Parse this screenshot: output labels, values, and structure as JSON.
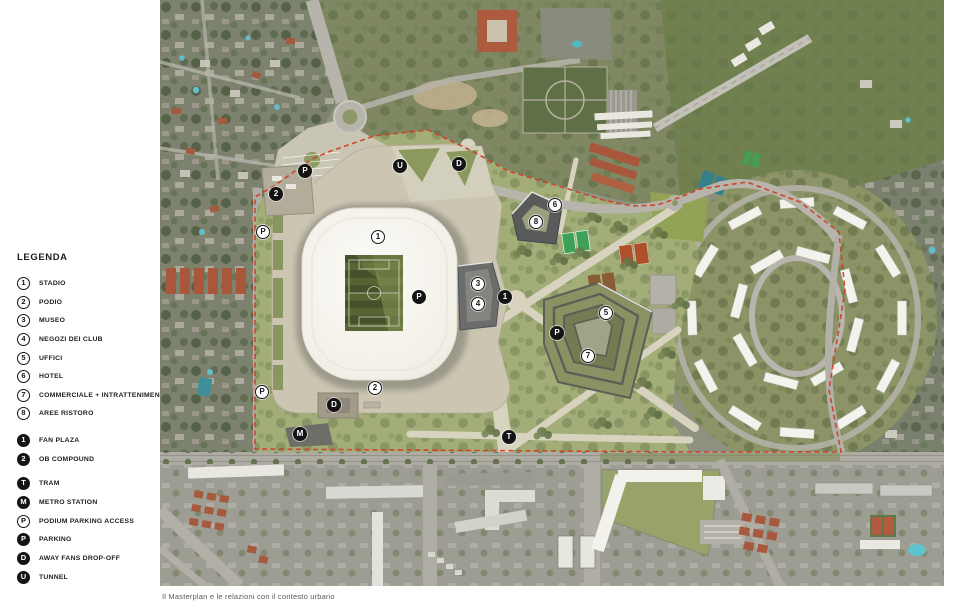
{
  "legend": {
    "title": "LEGENDA",
    "items": [
      {
        "symbol": "1",
        "label": "STADIO",
        "variant": "outline"
      },
      {
        "symbol": "2",
        "label": "PODIO",
        "variant": "outline"
      },
      {
        "symbol": "3",
        "label": "MUSEO",
        "variant": "outline"
      },
      {
        "symbol": "4",
        "label": "NEGOZI DEI CLUB",
        "variant": "outline"
      },
      {
        "symbol": "5",
        "label": "UFFICI",
        "variant": "outline"
      },
      {
        "symbol": "6",
        "label": "HOTEL",
        "variant": "outline"
      },
      {
        "symbol": "7",
        "label": "COMMERCIALE + INTRATTENIMENTO",
        "variant": "outline"
      },
      {
        "symbol": "8",
        "label": "AREE RISTORO",
        "variant": "outline"
      },
      {
        "symbol": "1",
        "label": "FAN PLAZA",
        "variant": "filled"
      },
      {
        "symbol": "2",
        "label": "OB COMPOUND",
        "variant": "filled"
      },
      {
        "symbol": "T",
        "label": "TRAM",
        "variant": "filled"
      },
      {
        "symbol": "M",
        "label": "METRO STATION",
        "variant": "filled"
      },
      {
        "symbol": "P",
        "label": "PODIUM PARKING ACCESS",
        "variant": "outline"
      },
      {
        "symbol": "P",
        "label": "PARKING",
        "variant": "filled"
      },
      {
        "symbol": "D",
        "label": "AWAY FANS DROP-OFF",
        "variant": "filled"
      },
      {
        "symbol": "U",
        "label": "TUNNEL",
        "variant": "filled"
      }
    ]
  },
  "map": {
    "markers": [
      {
        "symbol": "1",
        "variant": "outline"
      },
      {
        "symbol": "2",
        "variant": "outline"
      },
      {
        "symbol": "3",
        "variant": "outline"
      },
      {
        "symbol": "4",
        "variant": "outline"
      },
      {
        "symbol": "5",
        "variant": "outline"
      },
      {
        "symbol": "6",
        "variant": "outline"
      },
      {
        "symbol": "7",
        "variant": "outline"
      },
      {
        "symbol": "8",
        "variant": "outline"
      },
      {
        "symbol": "1",
        "variant": "filled"
      },
      {
        "symbol": "2",
        "variant": "filled"
      },
      {
        "symbol": "T",
        "variant": "filled"
      },
      {
        "symbol": "M",
        "variant": "filled"
      },
      {
        "symbol": "P",
        "variant": "outline"
      },
      {
        "symbol": "P",
        "variant": "outline"
      },
      {
        "symbol": "P",
        "variant": "filled"
      },
      {
        "symbol": "P",
        "variant": "filled"
      },
      {
        "symbol": "P",
        "variant": "filled"
      },
      {
        "symbol": "D",
        "variant": "filled"
      },
      {
        "symbol": "D",
        "variant": "filled"
      },
      {
        "symbol": "U",
        "variant": "filled"
      }
    ]
  },
  "caption": "Il Masterplan e le relazioni con il contesto urbano",
  "colors": {
    "boundary_red": "#cf3f28",
    "marker_black": "#141414",
    "park_green": "#a2ad78",
    "podium_beige": "#cbc5b2",
    "stadium_white": "#f4f2ec",
    "pitch_green": "#4a5730"
  }
}
